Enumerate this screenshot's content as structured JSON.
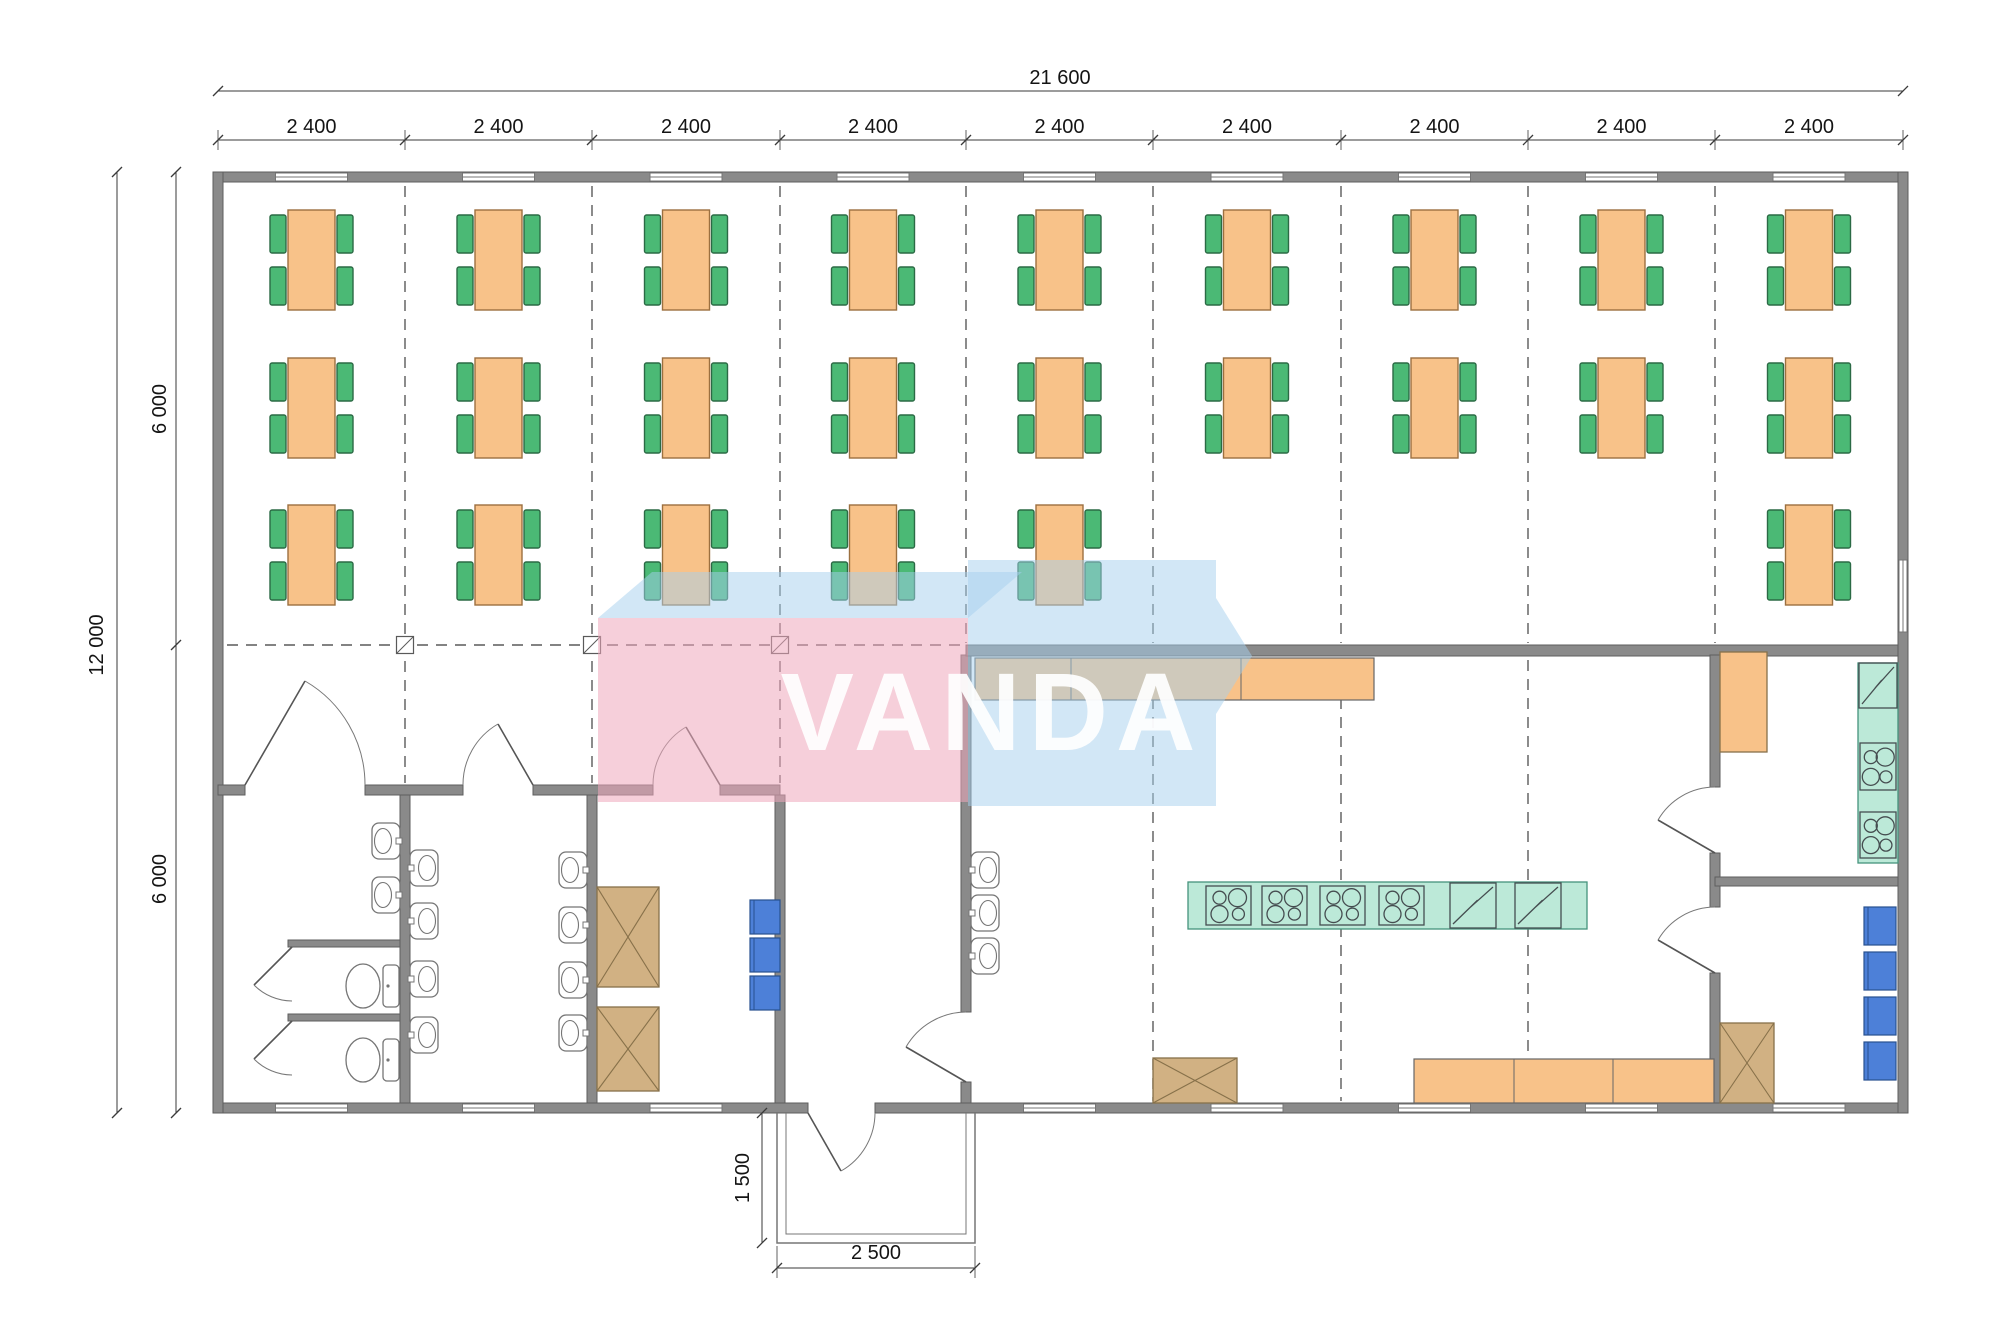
{
  "watermark": {
    "text": "VANDA"
  },
  "dimensions": {
    "overall_width": "21 600",
    "bay_width_labels": [
      "2 400",
      "2 400",
      "2 400",
      "2 400",
      "2 400",
      "2 400",
      "2 400",
      "2 400",
      "2 400"
    ],
    "overall_height": "12 000",
    "half_height_labels": [
      "6 000",
      "6 000"
    ],
    "porch_depth": "1 500",
    "porch_width": "2 500"
  },
  "grid": {
    "bays": 9,
    "bay_mm": 2400,
    "total_mm_width": 21600,
    "total_mm_height": 12000,
    "boundaries_px": [
      218,
      405,
      592,
      780,
      966,
      1153,
      1341,
      1528,
      1715,
      1903
    ],
    "mid_y_px": 645
  },
  "furniture": {
    "dining_rows": [
      {
        "y": 210,
        "bays": [
          1,
          2,
          3,
          4,
          5,
          6,
          7,
          8,
          9
        ]
      },
      {
        "y": 358,
        "bays": [
          1,
          2,
          3,
          4,
          5,
          6,
          7,
          8,
          9
        ]
      },
      {
        "y": 505,
        "bays": [
          1,
          2,
          3,
          4,
          5,
          9
        ]
      }
    ],
    "table": {
      "w": 47,
      "h": 100
    },
    "chair": {
      "w": 16,
      "h": 38
    },
    "kitchen_equipment_line": {
      "x": 1188,
      "y": 882,
      "w": 399,
      "h": 47,
      "stove_cells_x": [
        1206,
        1262,
        1320,
        1379
      ],
      "washer_cells_x": [
        1450,
        1515
      ]
    },
    "right_room_column": {
      "x": 1858,
      "y": 663,
      "w": 40,
      "units": [
        {
          "type": "washer",
          "y": 663,
          "h": 45
        },
        {
          "type": "stove",
          "y": 743,
          "h": 47
        },
        {
          "type": "stove",
          "y": 812,
          "h": 46
        }
      ]
    },
    "serving_counter": {
      "x": 975,
      "y": 658,
      "w": 399,
      "h": 42,
      "dividers_x": [
        1071,
        1241
      ]
    },
    "bottom_counter": {
      "x": 1414,
      "y": 1059,
      "w": 300,
      "h": 44,
      "dividers_x": [
        1514,
        1613
      ]
    },
    "wash_sinks": {
      "room_a_east_wall": {
        "x": 372,
        "ys": [
          823,
          877
        ],
        "facing": "left"
      },
      "room_b_west_wall": {
        "x": 410,
        "ys": [
          850,
          903,
          961,
          1017
        ],
        "facing": "right"
      },
      "room_b_east_wall": {
        "x": 559,
        "ys": [
          852,
          907,
          962,
          1015
        ],
        "facing": "left"
      },
      "kitchen_west_wall": {
        "x": 971,
        "ys": [
          852,
          895,
          938
        ],
        "facing": "right"
      }
    },
    "toilets_cy": [
      986,
      1060
    ],
    "blue_lockers": {
      "cloakroom": {
        "x": 750,
        "w": 30,
        "h": 34,
        "ys": [
          900,
          938,
          976
        ]
      },
      "right_room": {
        "x": 1864,
        "w": 32,
        "h": 38,
        "ys": [
          907,
          952,
          997,
          1042
        ]
      }
    },
    "crossed_cabinets": [
      {
        "x": 597,
        "y": 887,
        "w": 62,
        "h": 100
      },
      {
        "x": 597,
        "y": 1007,
        "w": 62,
        "h": 84
      },
      {
        "x": 1153,
        "y": 1058,
        "w": 84,
        "h": 45
      },
      {
        "x": 1720,
        "y": 1023,
        "w": 54,
        "h": 80
      },
      {
        "x": 1720,
        "y": 652,
        "w": 47,
        "h": 100,
        "plain": true
      }
    ]
  },
  "colors": {
    "wall": "#8a8a8a",
    "wall_stroke": "#5e5e5e",
    "table": "#f8c289",
    "table_stroke": "#9c7040",
    "chair": "#4bb975",
    "chair_stroke": "#2b6a45",
    "counter": "#f8c289",
    "counter_stroke": "#666666",
    "teal": "#bce9d8",
    "teal_stroke": "#45937d",
    "equip_stroke": "#454d50",
    "tan": "#d1b183",
    "tan_stroke": "#87714a",
    "blue": "#4d80d8",
    "blue_stroke": "#28518f",
    "fixture_stroke": "#757575",
    "dash": "#5a5a5a",
    "dim_line": "#3a3a3a",
    "dim_text": "#141414",
    "wm_pink": "#efa7bb",
    "wm_blue": "#a6d0ee",
    "wm_text": "#ffffff"
  }
}
